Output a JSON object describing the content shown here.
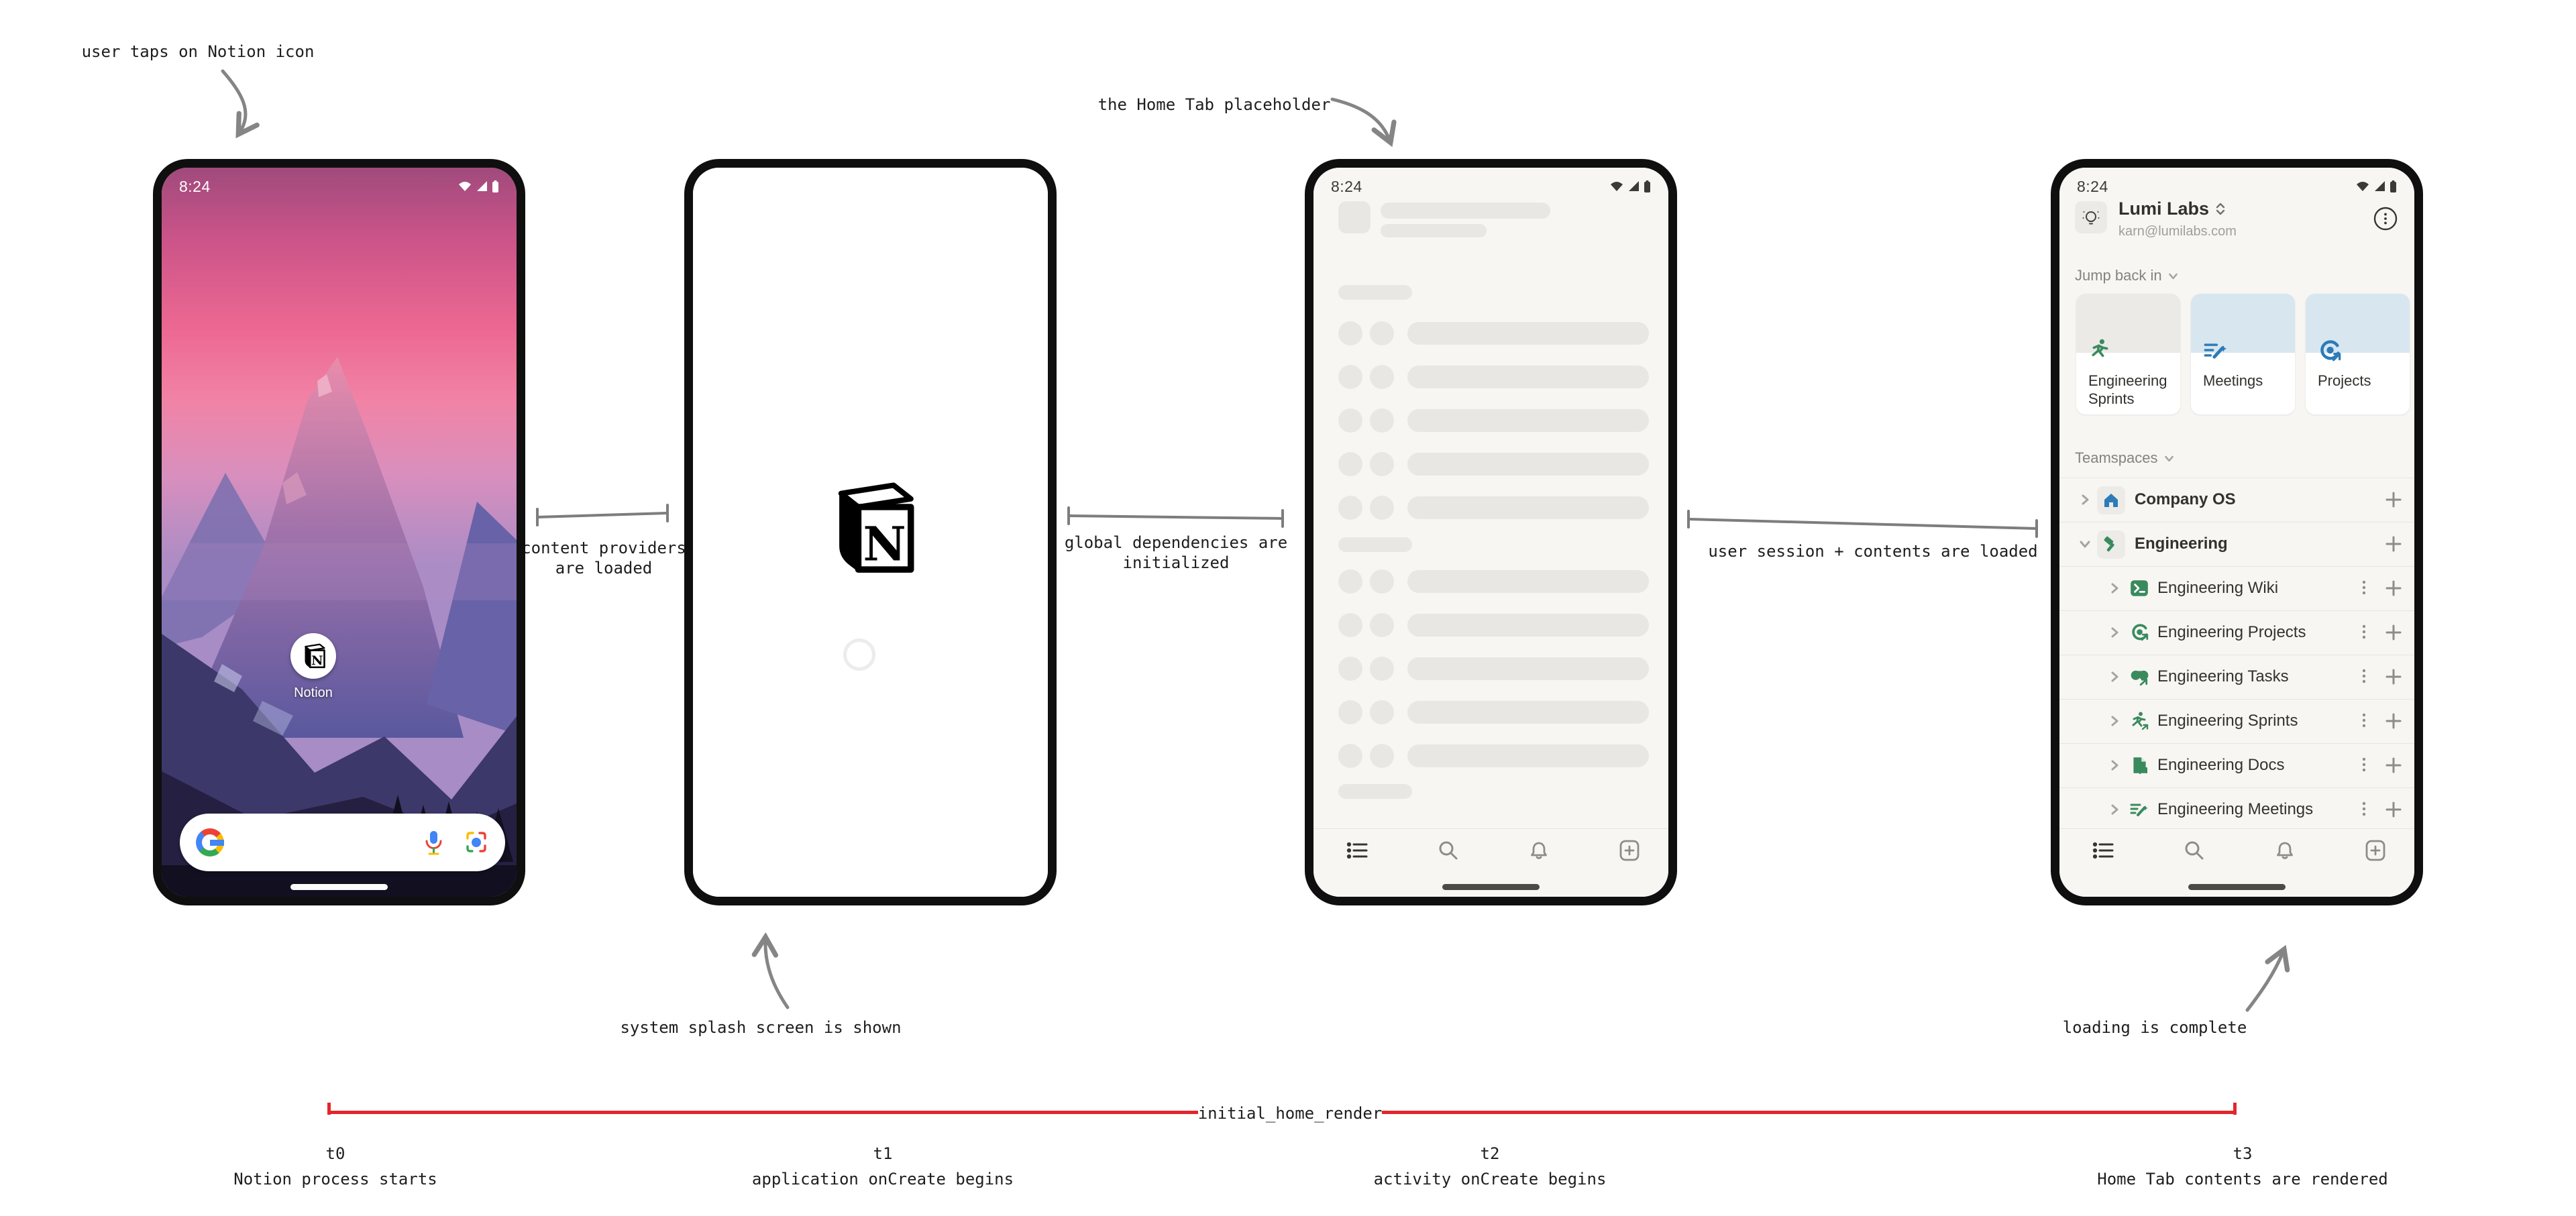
{
  "annotations": {
    "tap": "user taps on Notion icon",
    "content_providers_1": "content providers",
    "content_providers_2": "are loaded",
    "splash": "system splash screen is shown",
    "home_tab": "the Home Tab placeholder",
    "global_deps_1": "global dependencies are",
    "global_deps_2": "initialized",
    "user_session": "user session + contents are loaded",
    "loading_complete": "loading is complete"
  },
  "timeline": {
    "label": "initial_home_render",
    "color": "#e3262c",
    "ticks": [
      {
        "t": "t0",
        "desc": "Notion process starts"
      },
      {
        "t": "t1",
        "desc": "application onCreate begins"
      },
      {
        "t": "t2",
        "desc": "activity onCreate begins"
      },
      {
        "t": "t3",
        "desc": "Home Tab contents are rendered"
      }
    ]
  },
  "phone1": {
    "time": "8:24",
    "app_label": "Notion"
  },
  "phone3": {
    "time": "8:24"
  },
  "phone4": {
    "time": "8:24",
    "workspace": "Lumi Labs",
    "email": "karn@lumilabs.com",
    "sections": {
      "jump_back_in": "Jump back in",
      "teamspaces": "Teamspaces"
    },
    "cards": [
      {
        "title": "Engineering Sprints",
        "icon": "runner-icon",
        "tint": "#ebeae7"
      },
      {
        "title": "Meetings",
        "icon": "meeting-notes-icon",
        "tint": "#d8e6f0"
      },
      {
        "title": "Projects",
        "icon": "projects-icon",
        "tint": "#d8e6f0"
      }
    ],
    "rows": [
      {
        "label": "Company OS",
        "icon": "home-icon"
      },
      {
        "label": "Engineering",
        "icon": "hammer-icon"
      },
      {
        "label": "Engineering Wiki",
        "icon": "terminal-icon"
      },
      {
        "label": "Engineering Projects",
        "icon": "target-icon"
      },
      {
        "label": "Engineering Tasks",
        "icon": "binoculars-icon"
      },
      {
        "label": "Engineering Sprints",
        "icon": "runner-icon"
      },
      {
        "label": "Engineering Docs",
        "icon": "document-icon"
      },
      {
        "label": "Engineering Meetings",
        "icon": "meeting-notes-icon"
      }
    ],
    "icon_green": "#3a8a5d",
    "icon_blue": "#2d7bb8"
  }
}
